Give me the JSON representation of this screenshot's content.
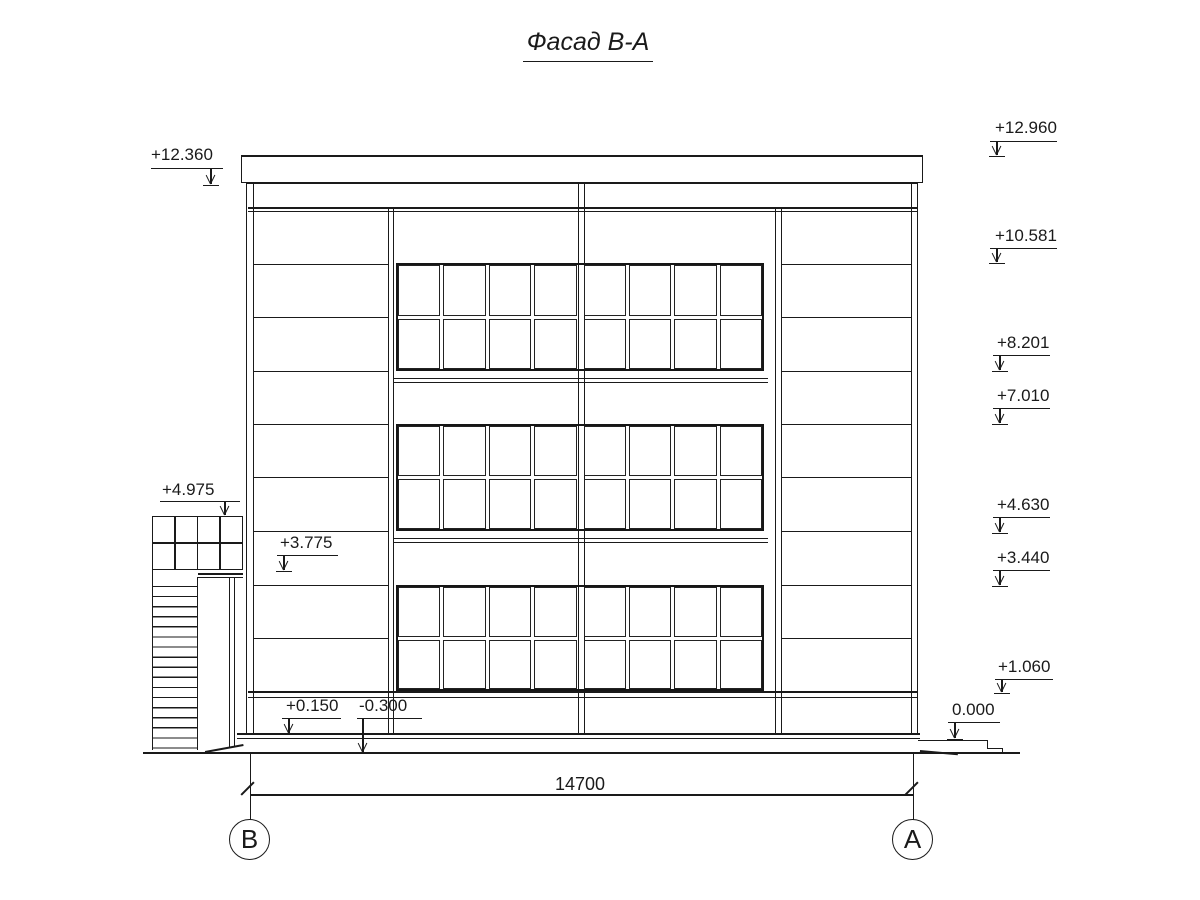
{
  "drawing": {
    "title": "Фасад В-А",
    "dimension_value": "14700",
    "axis_labels": {
      "left": "В",
      "right": "А"
    },
    "elevation_marks": {
      "left": [
        "+12.360",
        "+4.975",
        "+3.775",
        "+0.150",
        "-0.300"
      ],
      "right": [
        "+12.960",
        "+10.581",
        "+8.201",
        "+7.010",
        "+4.630",
        "+3.440",
        "+1.060",
        "0.000"
      ]
    },
    "colors": {
      "line": "#1a1a1a",
      "background": "#ffffff"
    }
  }
}
